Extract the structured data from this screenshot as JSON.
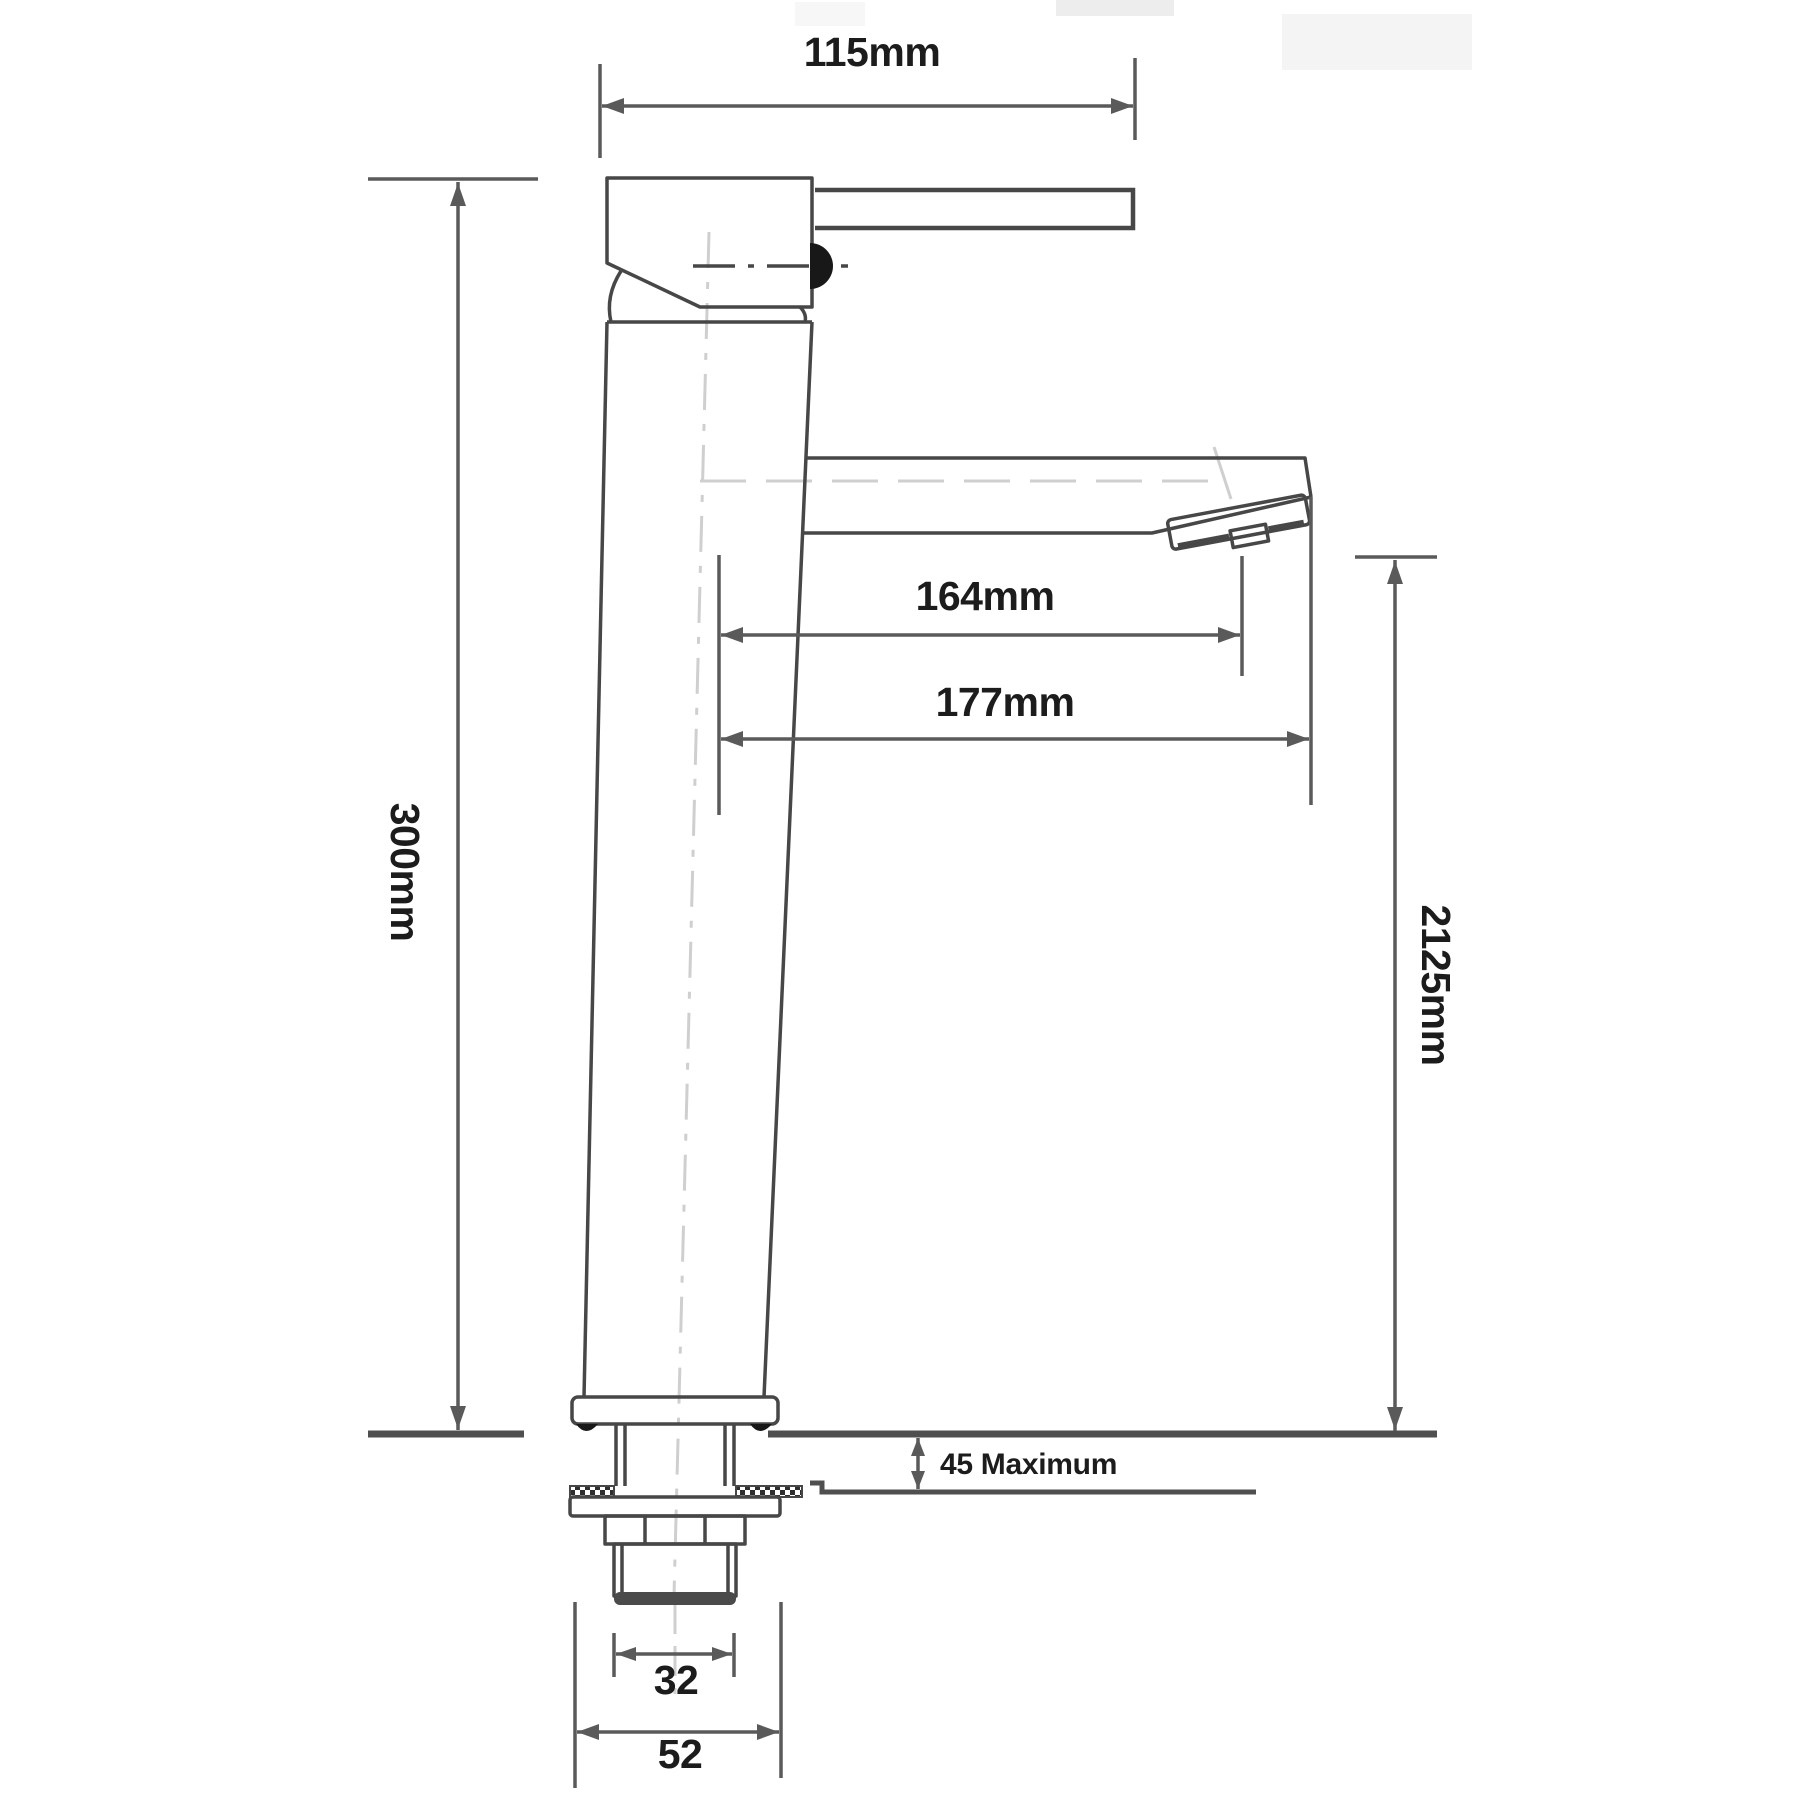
{
  "drawing": {
    "title": "Tall basin mixer tap - dimensioned side elevation",
    "view": "side elevation technical line drawing"
  },
  "labels": {
    "width_top": "115mm",
    "overall_height": "300mm",
    "reach_to_aerator": "164mm",
    "reach_to_tip": "177mm",
    "tip_height": "2125mm",
    "deck_max": "45 Maximum",
    "thread_diameter": "32",
    "base_diameter": "52"
  },
  "colors": {
    "line": "#474747",
    "dimension_line": "#5a5a5a",
    "text": "#1c1c1c",
    "faint_centerline": "#cfcfcf",
    "background": "#ffffff"
  }
}
